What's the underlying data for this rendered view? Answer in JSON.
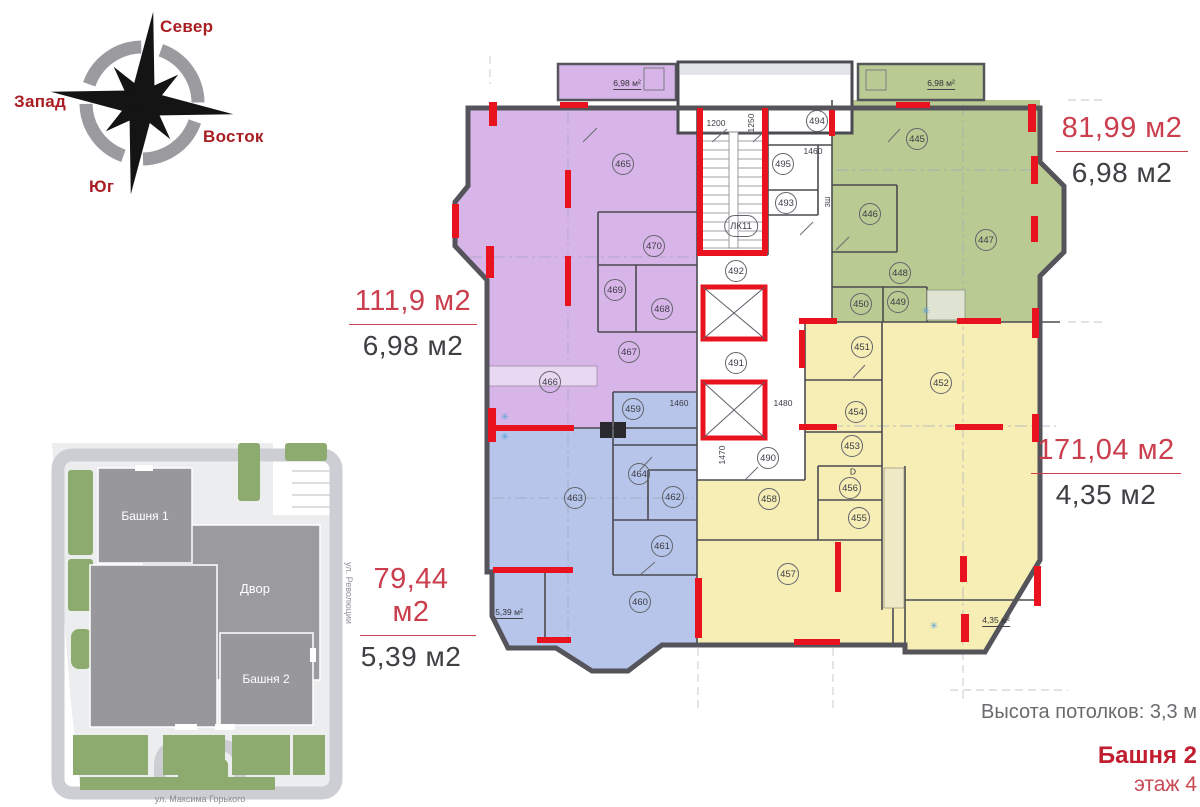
{
  "palette": {
    "purple": "#d8b5e8",
    "green": "#b9cb93",
    "yellow": "#f6eeb5",
    "blue": "#b6c5e9",
    "wall_red": "#e8131f",
    "label_red": "#ca3e4e",
    "brand_red": "#c11f30",
    "compass_red": "#a91e23"
  },
  "compass": {
    "north": "Север",
    "west": "Запад",
    "east": "Восток",
    "south": "Юг"
  },
  "apartments": [
    {
      "name": "green-apartment",
      "area_label": "81,99 м2",
      "balcony_label": "6,98 м2"
    },
    {
      "name": "purple-apartment",
      "area_label": "111,9 м2",
      "balcony_label": "6,98 м2"
    },
    {
      "name": "yellow-apartment",
      "area_label": "171,04 м2",
      "balcony_label": "4,35 м2"
    },
    {
      "name": "blue-apartment",
      "area_label": "79,44 м2",
      "balcony_label": "5,39 м2"
    }
  ],
  "rooms": [
    {
      "n": "465",
      "x": 623,
      "y": 164
    },
    {
      "n": "470",
      "x": 654,
      "y": 246
    },
    {
      "n": "469",
      "x": 615,
      "y": 290
    },
    {
      "n": "468",
      "x": 662,
      "y": 309
    },
    {
      "n": "467",
      "x": 629,
      "y": 352
    },
    {
      "n": "466",
      "x": 550,
      "y": 382
    },
    {
      "n": "459",
      "x": 633,
      "y": 409
    },
    {
      "n": "464",
      "x": 639,
      "y": 474
    },
    {
      "n": "463",
      "x": 575,
      "y": 498
    },
    {
      "n": "462",
      "x": 673,
      "y": 497
    },
    {
      "n": "461",
      "x": 662,
      "y": 546
    },
    {
      "n": "460",
      "x": 640,
      "y": 602
    },
    {
      "n": "ЛК11",
      "x": 741,
      "y": 226
    },
    {
      "n": "494",
      "x": 817,
      "y": 121
    },
    {
      "n": "495",
      "x": 783,
      "y": 164
    },
    {
      "n": "493",
      "x": 786,
      "y": 203
    },
    {
      "n": "492",
      "x": 736,
      "y": 271
    },
    {
      "n": "491",
      "x": 736,
      "y": 363
    },
    {
      "n": "490",
      "x": 768,
      "y": 458
    },
    {
      "n": "445",
      "x": 917,
      "y": 139
    },
    {
      "n": "446",
      "x": 870,
      "y": 214
    },
    {
      "n": "447",
      "x": 986,
      "y": 240
    },
    {
      "n": "448",
      "x": 900,
      "y": 273
    },
    {
      "n": "450",
      "x": 861,
      "y": 304
    },
    {
      "n": "449",
      "x": 898,
      "y": 302
    },
    {
      "n": "451",
      "x": 862,
      "y": 347
    },
    {
      "n": "452",
      "x": 941,
      "y": 383
    },
    {
      "n": "454",
      "x": 856,
      "y": 412
    },
    {
      "n": "453",
      "x": 852,
      "y": 446
    },
    {
      "n": "456",
      "x": 850,
      "y": 488
    },
    {
      "n": "455",
      "x": 859,
      "y": 518
    },
    {
      "n": "458",
      "x": 769,
      "y": 499
    },
    {
      "n": "457",
      "x": 788,
      "y": 574
    }
  ],
  "dimensions": [
    {
      "t": "1200",
      "x": 716,
      "y": 123,
      "r": 0
    },
    {
      "t": "1250",
      "x": 751,
      "y": 123,
      "r": -90
    },
    {
      "t": "1460",
      "x": 813,
      "y": 151,
      "r": 0
    },
    {
      "t": "1460",
      "x": 679,
      "y": 403,
      "r": 0
    },
    {
      "t": "1480",
      "x": 783,
      "y": 403,
      "r": 0
    },
    {
      "t": "1470",
      "x": 722,
      "y": 455,
      "r": -90
    }
  ],
  "inline_labels": [
    {
      "t": "6,98 м²",
      "x": 627,
      "y": 84
    },
    {
      "t": "6,98 м²",
      "x": 941,
      "y": 84
    },
    {
      "t": "5,39 м²",
      "x": 509,
      "y": 613
    },
    {
      "t": "4,35 м²",
      "x": 996,
      "y": 621
    },
    {
      "t": "ЗШ",
      "x": 829,
      "y": 202,
      "r": -90,
      "cls": "tiny"
    },
    {
      "t": "D",
      "x": 853,
      "y": 472,
      "cls": "nou"
    },
    {
      "t": "✳",
      "x": 505,
      "y": 418,
      "cls": "snow"
    },
    {
      "t": "✳",
      "x": 505,
      "y": 438,
      "cls": "snow"
    },
    {
      "t": "✳",
      "x": 926,
      "y": 312,
      "cls": "snow"
    },
    {
      "t": "✳",
      "x": 934,
      "y": 627,
      "cls": "snow"
    }
  ],
  "site_plan": {
    "tower1": "Башня 1",
    "yard": "Двор",
    "tower2": "Башня 2",
    "street_right": "ул. Революции",
    "street_bottom": "ул. Максима Горького"
  },
  "footer": {
    "ceiling_height": "Высота потолков: 3,3 м",
    "tower": "Башня 2",
    "floor": "этаж 4"
  }
}
